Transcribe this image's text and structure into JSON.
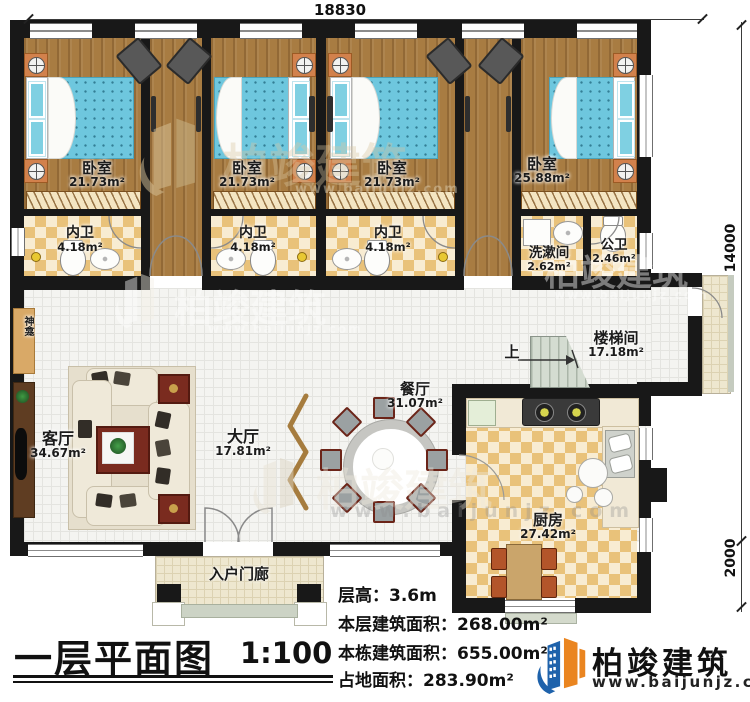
{
  "title": {
    "main": "一层平面图",
    "scale": "1:100"
  },
  "dimensions": {
    "top": "18830",
    "right_main": "14000",
    "right_porch": "2000"
  },
  "stairs": {
    "up": "上"
  },
  "rooms": {
    "bedroom1": {
      "name": "卧室",
      "area": "21.73m²"
    },
    "bedroom2": {
      "name": "卧室",
      "area": "21.73m²"
    },
    "bedroom3": {
      "name": "卧室",
      "area": "21.73m²"
    },
    "bedroom4": {
      "name": "卧室",
      "area": "25.88m²"
    },
    "bath1": {
      "name": "内卫",
      "area": "4.18m²"
    },
    "bath2": {
      "name": "内卫",
      "area": "4.18m²"
    },
    "bath3": {
      "name": "内卫",
      "area": "4.18m²"
    },
    "washroom": {
      "name": "洗漱间",
      "area": "2.62m²"
    },
    "publicbath": {
      "name": "公卫",
      "area": "2.46m²"
    },
    "stairwell": {
      "name": "楼梯间",
      "area": "17.18m²"
    },
    "dining": {
      "name": "餐厅",
      "area": "31.07m²"
    },
    "hall": {
      "name": "大厅",
      "area": "17.81m²"
    },
    "living": {
      "name": "客厅",
      "area": "34.67m²"
    },
    "kitchen": {
      "name": "厨房",
      "area": "27.42m²"
    },
    "porch": {
      "name": "入户门廊"
    },
    "shrine": {
      "name": "神龛"
    }
  },
  "specs": {
    "floor_height": {
      "label": "层高：",
      "value": "3.6m"
    },
    "floor_area": {
      "label": "本层建筑面积：",
      "value": "268.00m²"
    },
    "building_area": {
      "label": "本栋建筑面积：",
      "value": "655.00m²"
    },
    "footprint_area": {
      "label": "占地面积：",
      "value": "283.90m²"
    }
  },
  "brand": {
    "name": "柏竣建筑",
    "url": "www.baijunjz.com"
  },
  "watermark": {
    "name": "柏竣建筑",
    "url": "www.baijunjz.com"
  },
  "colors": {
    "wall": "#181818",
    "wood": "#a87c42",
    "bed": "#6ec7de",
    "checker": "#e9c27a",
    "brand_blue": "#1e62ab",
    "brand_orange": "#ea8520"
  }
}
